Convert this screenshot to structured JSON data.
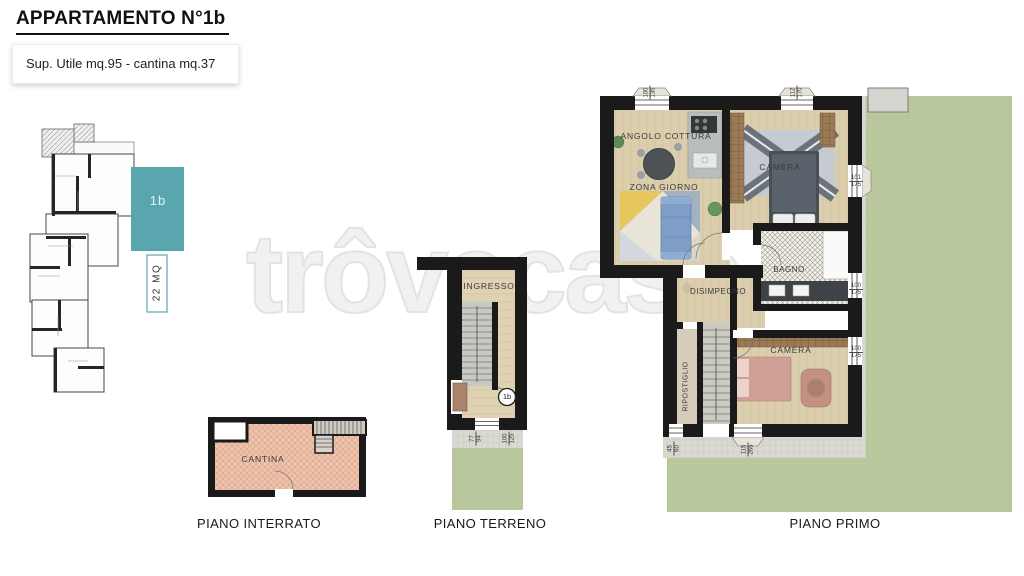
{
  "header": {
    "title": "APPARTAMENTO N°1b",
    "subtitle": "Sup. Utile mq.95 - cantina mq.37"
  },
  "key_plan": {
    "unit": "1b",
    "area": "22 MQ"
  },
  "watermark": "trôvacasa",
  "colors": {
    "accent_teal": "#5aa6ae",
    "grass_green": "#b9c89d",
    "cantina_pink": "#edc2ab",
    "wall_black": "#1a1a1a",
    "wood_floor": "#dbcead"
  },
  "floors": {
    "interrato": {
      "label": "PIANO INTERRATO",
      "room": "CANTINA"
    },
    "terreno": {
      "label": "PIANO TERRENO",
      "room": "INGRESSO",
      "unit_badge": "1b",
      "dims": [
        {
          "w": "77",
          "h": "94"
        },
        {
          "w": "100",
          "h": "125"
        }
      ]
    },
    "primo": {
      "label": "PIANO PRIMO",
      "rooms": {
        "angolo_cottura": "ANGOLO COTTURA",
        "zona_giorno": "ZONA GIORNO",
        "camera1": "CAMERA",
        "bagno": "BAGNO",
        "disimpegno": "DISIMPEGNO",
        "ripostiglio": "RIPOSTIGLIO",
        "camera2": "CAMERA"
      },
      "dims": [
        {
          "w": "100",
          "h": "135"
        },
        {
          "w": "112",
          "h": "170"
        },
        {
          "w": "101",
          "h": "175"
        },
        {
          "w": "100",
          "h": "175"
        },
        {
          "w": "100",
          "h": "175"
        },
        {
          "w": "45",
          "h": "60"
        },
        {
          "w": "115",
          "h": "265"
        }
      ]
    }
  }
}
